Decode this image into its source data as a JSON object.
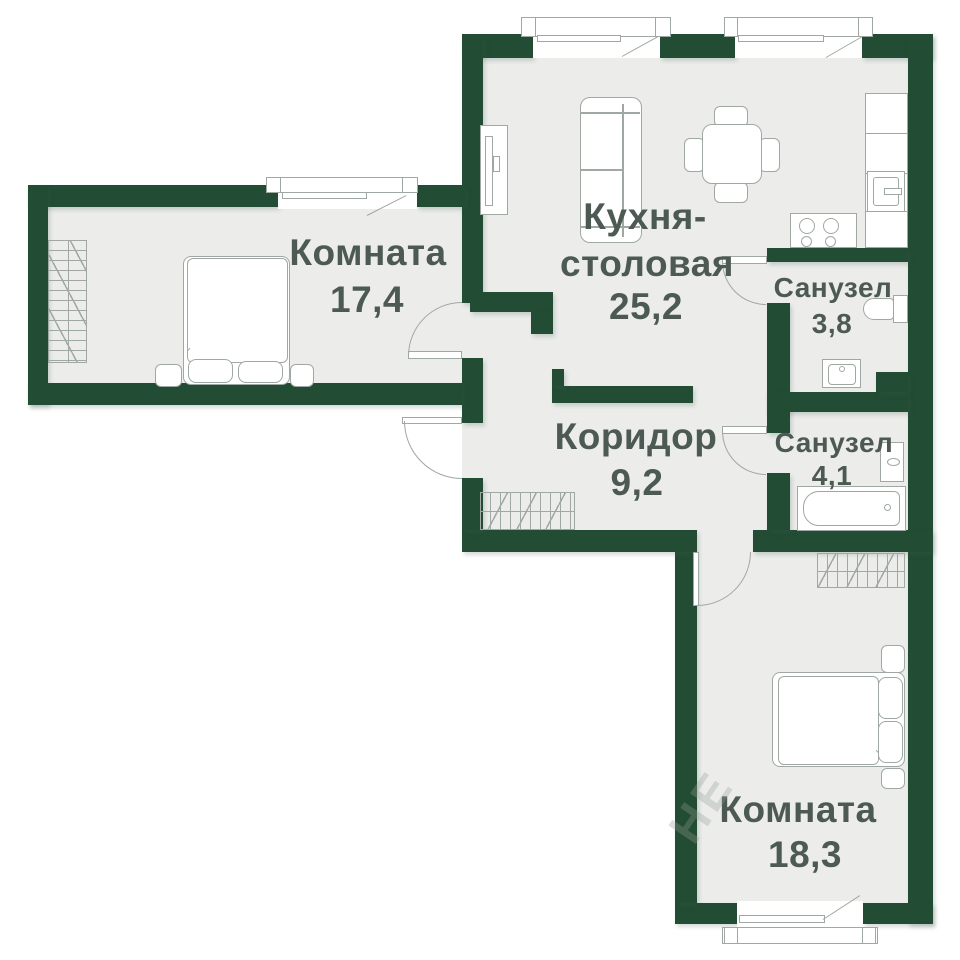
{
  "rooms": {
    "room1": {
      "label": "Комната",
      "area": "17,4"
    },
    "kitchen": {
      "label_line1": "Кухня-",
      "label_line2": "столовая",
      "area": "25,2"
    },
    "bath1": {
      "label": "Санузел",
      "area": "3,8"
    },
    "bath2": {
      "label": "Санузел",
      "area": "4,1"
    },
    "corridor": {
      "label": "Коридор",
      "area": "9,2"
    },
    "room2": {
      "label": "Комната",
      "area": "18,3"
    }
  },
  "watermark": "НЕ",
  "colors": {
    "wall": "#224c33",
    "floor": "#ecedeb",
    "line": "#a0a8a3",
    "text": "#4d5a54"
  }
}
